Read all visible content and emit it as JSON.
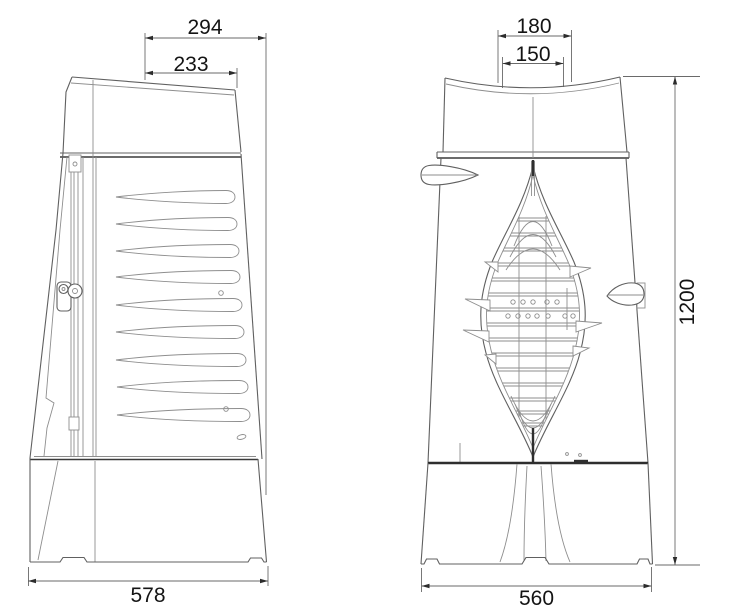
{
  "drawing": {
    "side_view": {
      "dimensions": {
        "top_outer": "294",
        "top_inner": "233",
        "base_width": "578"
      },
      "louver_count": 9
    },
    "front_view": {
      "dimensions": {
        "flue_outer": "180",
        "flue_inner": "150",
        "base_width": "560",
        "overall_height": "1200"
      }
    }
  }
}
